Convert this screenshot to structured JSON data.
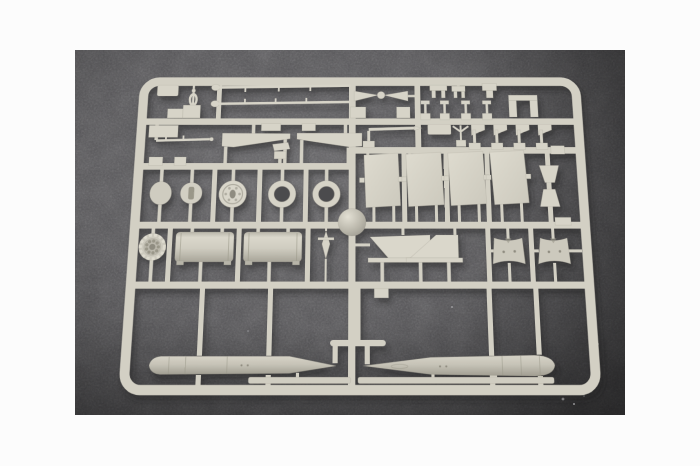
{
  "image": {
    "kind": "product-photograph",
    "subject": "injection-molded model kit sprue (parts tree) with unpainted tan plastic parts",
    "surface": "dark gray felt",
    "border": "white photo margin"
  },
  "colors": {
    "page_bg": "#fcfcfc",
    "felt_base": "#59585b",
    "felt_hole": "#4c4b4e",
    "plastic_rail": "#d3d0c4",
    "plastic_part": "#d7d4c8",
    "plastic_light": "#dedbcf",
    "plastic_mid": "#c9c6ba",
    "plastic_dark": "#a5a296",
    "detail_dark": "#8f8c80",
    "lint": "#cfcfd2"
  },
  "sprue": {
    "frame_shape": "rounded-rectangle runner frame with internal rails",
    "parts": [
      {
        "name": "long-thin-rod",
        "count": 2
      },
      {
        "name": "turnbuckle-link",
        "count": 1
      },
      {
        "name": "corner-plate",
        "count": 1
      },
      {
        "name": "step-block",
        "count": 2
      },
      {
        "name": "hull-wedge-half",
        "count": 2
      },
      {
        "name": "small-angle-bracket",
        "count": 1
      },
      {
        "name": "yardarm-bowtie",
        "count": 1
      },
      {
        "name": "hanging-clip",
        "count": 3
      },
      {
        "name": "t-pin",
        "count": 4
      },
      {
        "name": "u-bracket",
        "count": 1
      },
      {
        "name": "boom-rod",
        "count": 1
      },
      {
        "name": "flat-plate",
        "count": 1
      },
      {
        "name": "tiny-anchor-post",
        "count": 1
      },
      {
        "name": "angled-flag-bracket",
        "count": 4
      },
      {
        "name": "flat-panel",
        "count": 4
      },
      {
        "name": "trapezoid-block",
        "count": 2
      },
      {
        "name": "plain-disc",
        "count": 1
      },
      {
        "name": "slotted-disc",
        "count": 1
      },
      {
        "name": "hub-disc",
        "count": 1
      },
      {
        "name": "ring",
        "count": 2
      },
      {
        "name": "dome-ball",
        "count": 1
      },
      {
        "name": "perforated-gear-disc",
        "count": 1
      },
      {
        "name": "half-cylinder",
        "count": 2
      },
      {
        "name": "finned-dart",
        "count": 1
      },
      {
        "name": "tail-fin",
        "count": 2
      },
      {
        "name": "saddle-cowl",
        "count": 2
      },
      {
        "name": "torpedo-hull-half",
        "count": 2
      },
      {
        "name": "thin-strip",
        "count": 2
      }
    ]
  }
}
